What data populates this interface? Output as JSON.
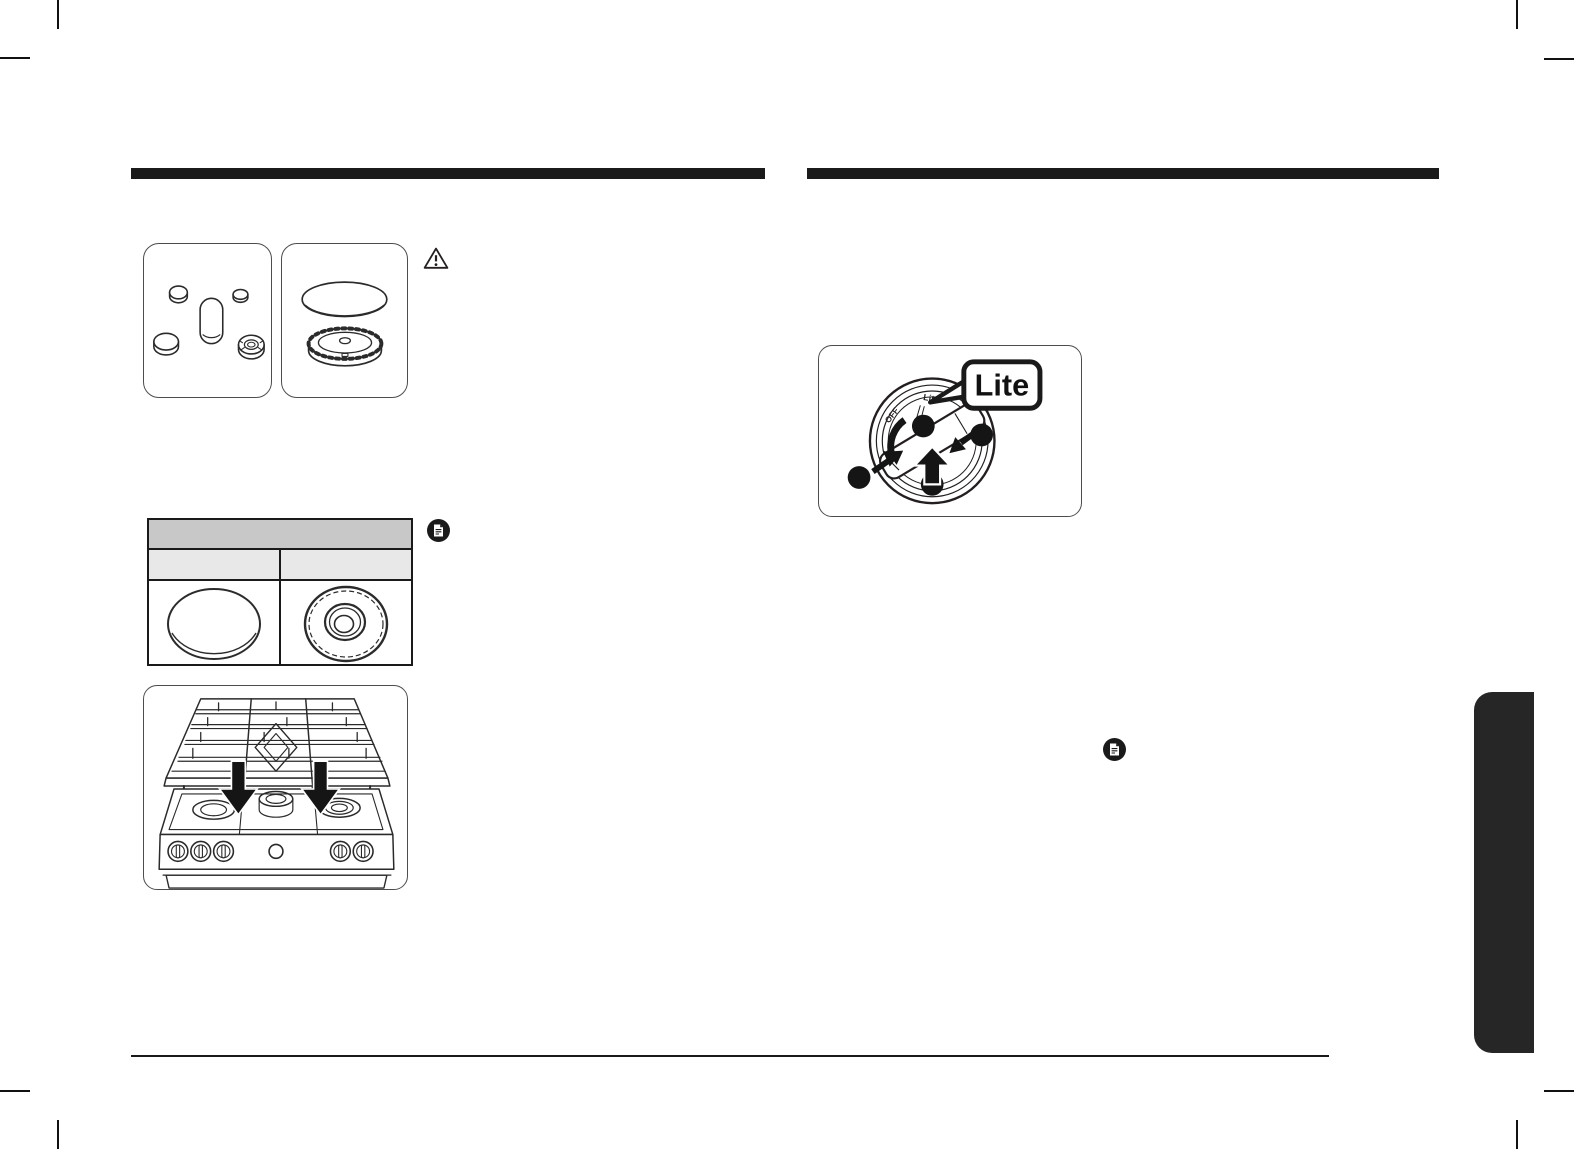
{
  "figures": {
    "knob": {
      "bubble_label": "Lite",
      "dial_label_lite": "Lite",
      "dial_label_off": "OFF"
    }
  },
  "icons": {
    "warning_icon": "exclamation-triangle-outline",
    "note_icon": "document-page-in-black-circle",
    "down_arrow": "solid-black-down-arrow",
    "up_arrow": "solid-black-up-arrow"
  },
  "colors": {
    "ink": "#231f20",
    "section_bar": "#1b1b1b",
    "table_header_fill": "#c8c8c8",
    "table_subheader_fill": "#e8e8e8",
    "side_tab_fill": "#262626",
    "page_background": "#ffffff"
  }
}
